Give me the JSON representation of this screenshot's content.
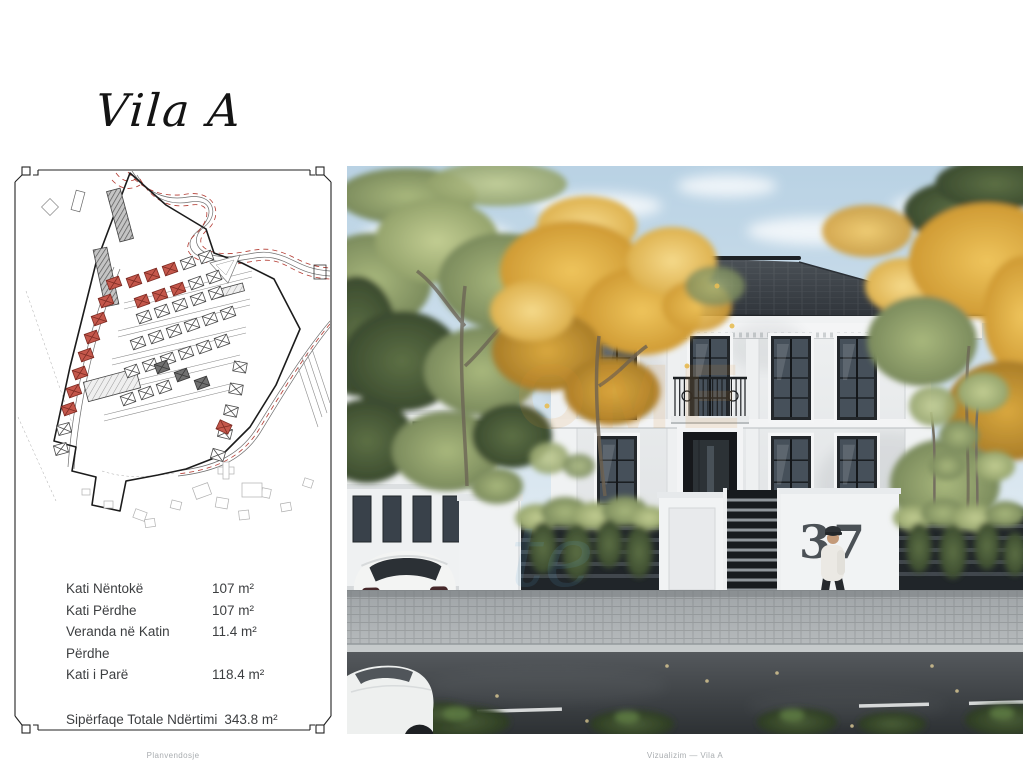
{
  "page": {
    "title": "Vila A",
    "footer_left": "Planvendosje",
    "footer_right": "Vizualizim — Vila A"
  },
  "measurements": {
    "rows": [
      {
        "label": "Kati Nëntokë",
        "value": "107 m²"
      },
      {
        "label": "Kati Përdhe",
        "value": "107  m²"
      },
      {
        "label": "Veranda në Katin Përdhe",
        "value": "11.4  m²"
      },
      {
        "label": "Kati i Parë",
        "value": "118.4 m²"
      }
    ],
    "total": {
      "label": "Sipërfaqe Totale Ndërtimi",
      "value": "343.8 m²"
    }
  },
  "photo": {
    "house_number": "37"
  },
  "watermark": {
    "fragment_a": "OME",
    "fragment_b": "te"
  },
  "colors": {
    "red_house": "#c4574b",
    "road_dash_red": "#b33a31",
    "roof": "#3a4046",
    "sky": "#c9dcea",
    "autumn_leaf": "#e0b14e"
  }
}
